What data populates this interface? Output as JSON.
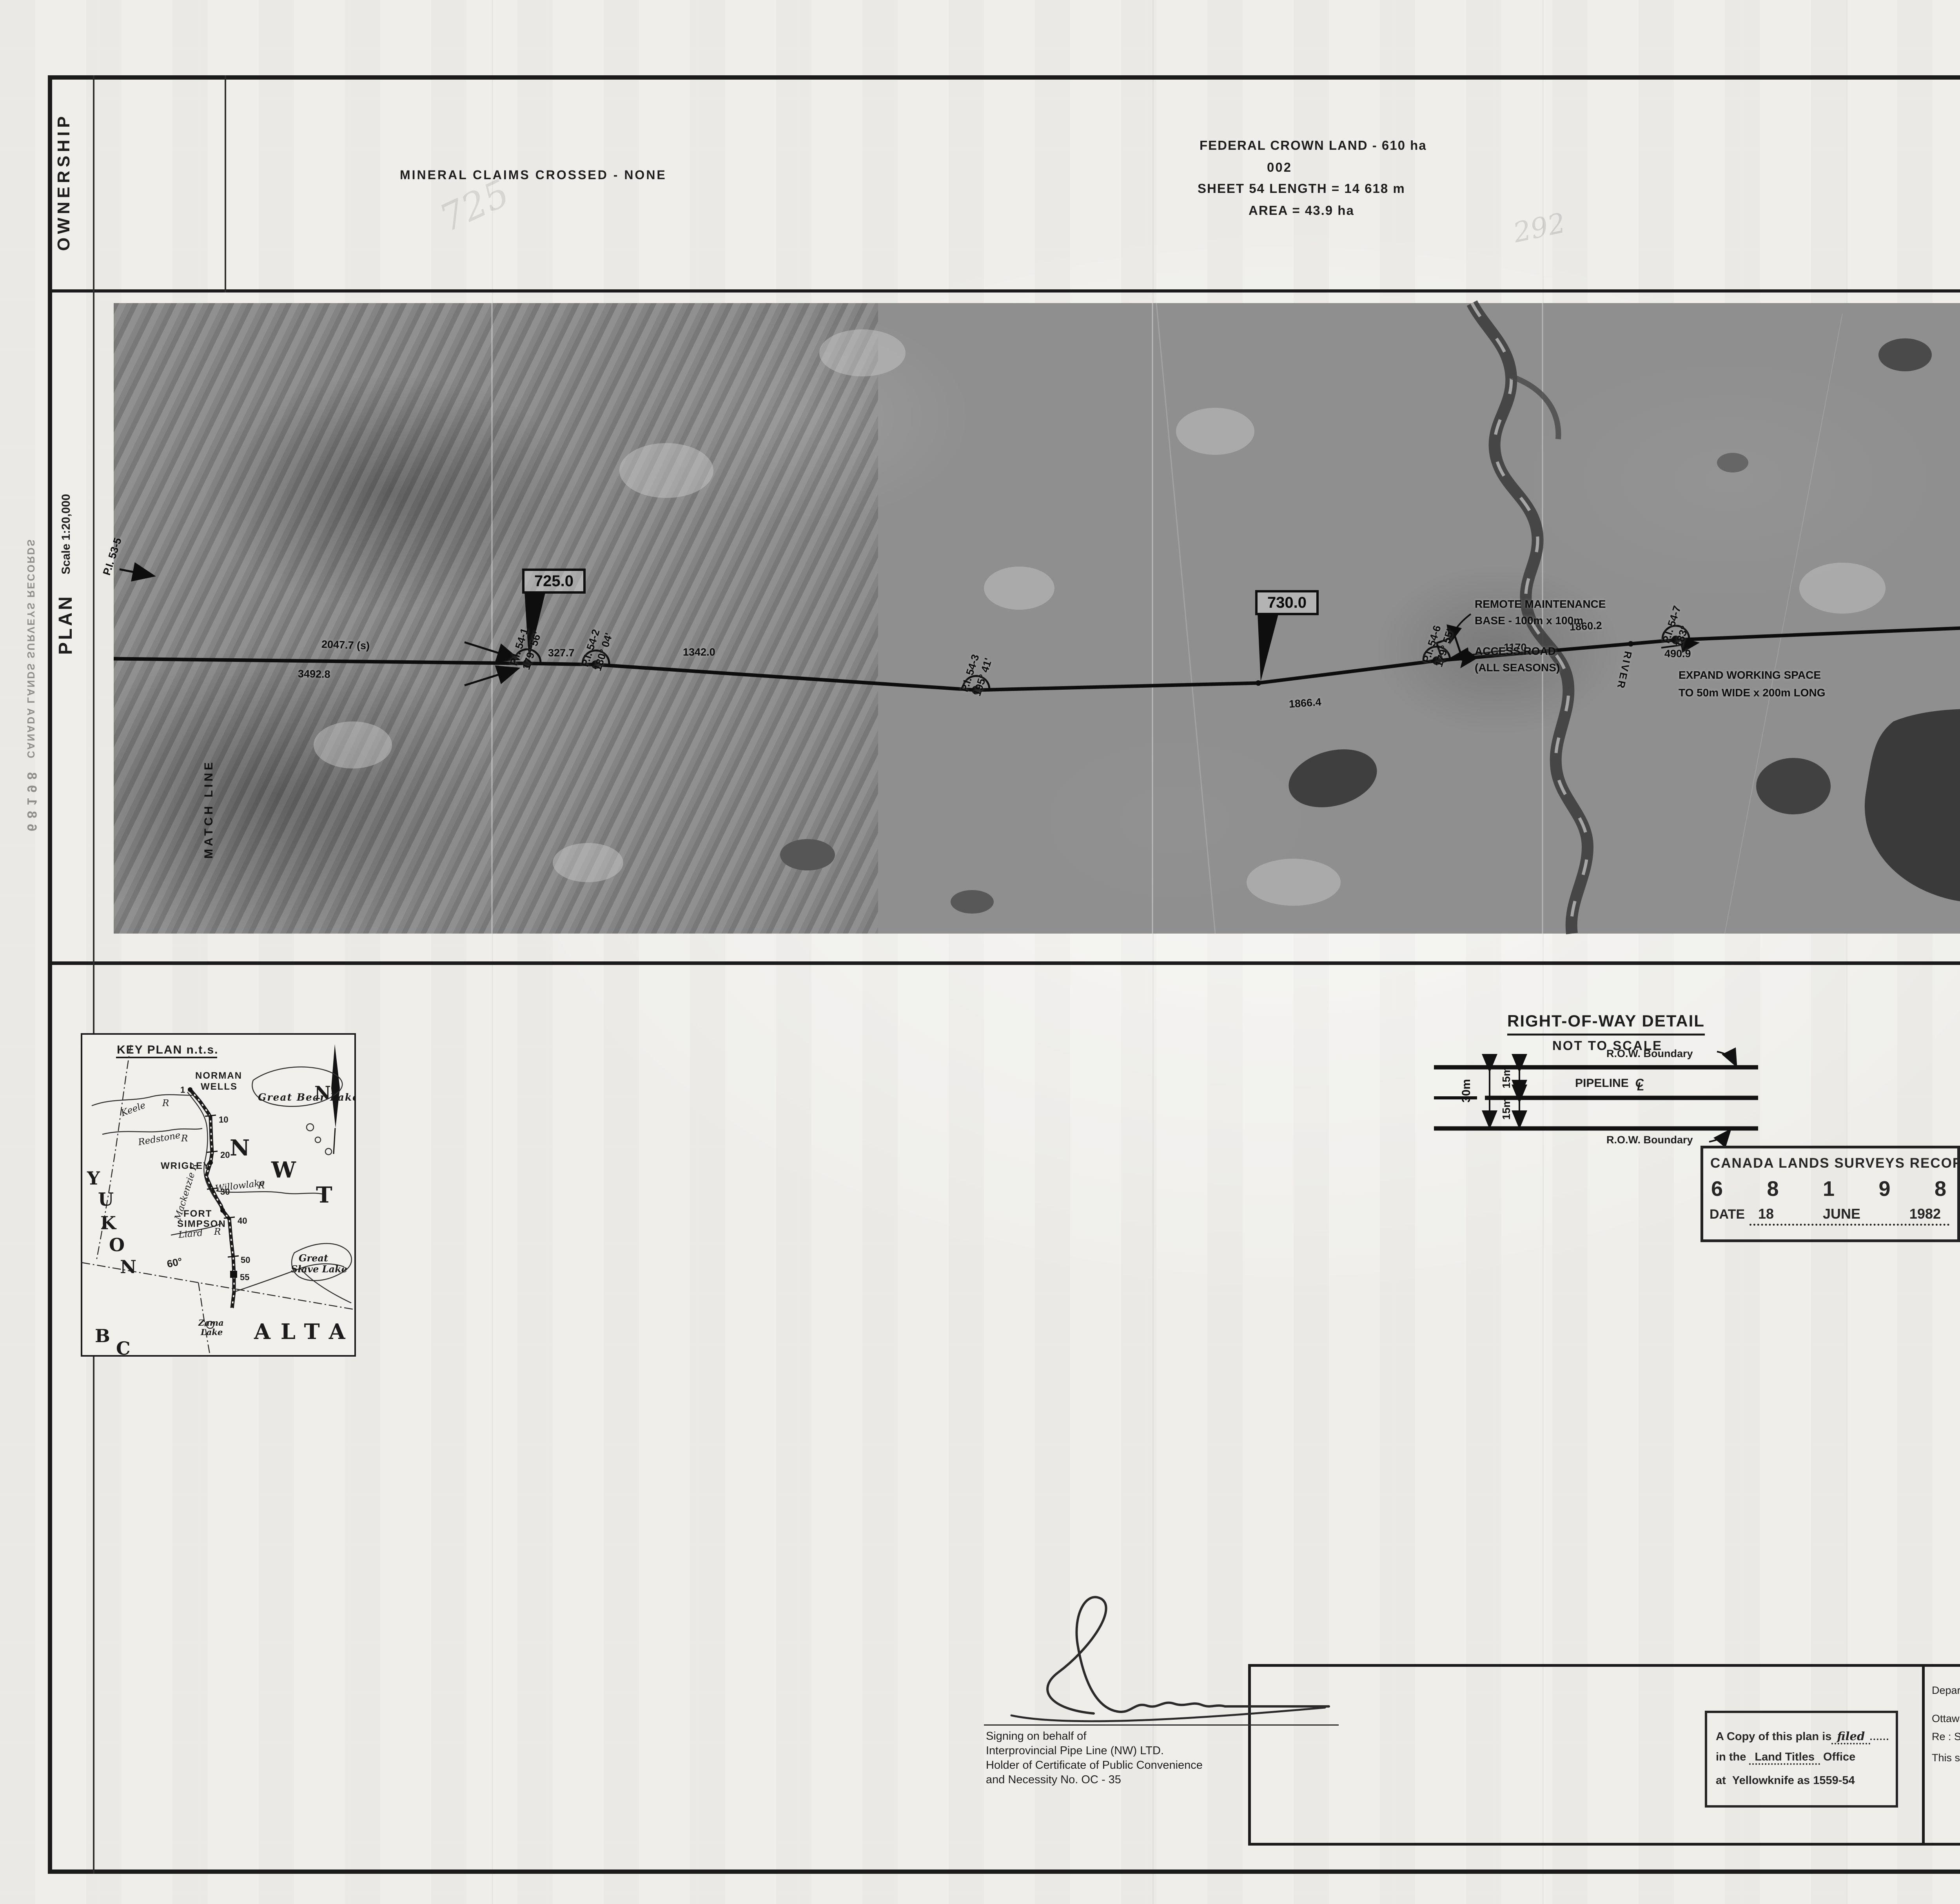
{
  "ownership": {
    "label": "OWNERSHIP",
    "mineral": "MINERAL CLAIMS CROSSED - NONE",
    "crown": "FEDERAL CROWN LAND - 610 ha",
    "parcel": "002",
    "length": "SHEET 54 LENGTH = 14 618 m",
    "area": "AREA   = 43.9 ha"
  },
  "sheetbox": {
    "word": "SHEET",
    "number": "54",
    "of": "of",
    "total": "55"
  },
  "planband": {
    "label": "PLAN",
    "scale": "Scale  1:20,000",
    "match": "MATCH LINE",
    "pencil1": "725",
    "pencil2": "292"
  },
  "photo": {
    "flag1": "725.0",
    "flag2": "730.0",
    "flag3": "735.0",
    "pi535": "P.I. 53-5",
    "pi541": "P.I. 54-1",
    "pi541a": "179° 56'",
    "pi542": "P.I. 54-2",
    "pi542a": "180° 04'",
    "pi543": "P.I. 54-3",
    "pi543a": "195° 41'",
    "pi546": "P.I. 54-6",
    "pi546a": "179° 55'",
    "pi547": "P.I. 54-7",
    "pi547a": "183°",
    "pi548": "P.I. 54-8",
    "pi548a": "189° 46'",
    "d1": "3492.8",
    "d2": "2047.7 (s)",
    "d3": "327.7",
    "d4": "1342.0",
    "d5": "1866.4",
    "d6": "1170",
    "d7": "1860.2",
    "d8": "490.9",
    "d9": "3783.7",
    "d10": "788.4",
    "d11": "5310.7",
    "remote1": "REMOTE MAINTENANCE",
    "remote2": "BASE - 100m x 100m",
    "access1": "ACCESS ROAD",
    "access2": "(ALL SEASONS)",
    "expand1": "EXPAND WORKING SPACE",
    "expand2": "TO 50m WIDE x 200m LONG",
    "river": "RIVER",
    "north": "N"
  },
  "keymap": {
    "title": "KEY PLAN n.t.s.",
    "norman1": "NORMAN",
    "norman2": "WELLS",
    "gbl": "Great Bear Lake",
    "keele": "Keele",
    "keele_r": "R",
    "redstone": "Redstone",
    "redstone_r": "R",
    "wrigley": "WRIGLEY",
    "mackenzie": "Mackenzie R",
    "willow": "Willowlake",
    "willow_r": "R",
    "fort": "FORT",
    "simpson": "SIMPSON",
    "liard": "Liard",
    "liard_r": "R",
    "sixty": "60°",
    "y": "Y",
    "u": "U",
    "k": "K",
    "o": "O",
    "n": "N",
    "nwt_n": "N",
    "nwt_w": "W",
    "nwt_t": "T",
    "b": "B",
    "c": "C",
    "alta": "ALTA",
    "gsl1": "Great",
    "gsl2": "Slave Lake",
    "zama1": "Zama",
    "zama2": "Lake",
    "north": "N",
    "t1": "1",
    "t10": "10",
    "t20": "20",
    "t30": "30",
    "t40": "40",
    "t50": "50",
    "t55": "55"
  },
  "rowdetail": {
    "title": "RIGHT-OF-WAY DETAIL",
    "nts": "NOT TO SCALE",
    "rowb_top": "R.O.W. Boundary",
    "rowb_bot": "R.O.W. Boundary",
    "pipeline": "PIPELINE",
    "cl_c": "C",
    "cl_l": "L",
    "dim30": "30m",
    "dim15a": "15m",
    "dim15b": "15m"
  },
  "clsr": {
    "title": "CANADA LANDS SURVEYS RECORDS",
    "d1": "6",
    "d2": "8",
    "d3": "1",
    "d4": "9",
    "d5": "8",
    "datelabel": "DATE",
    "day": "18",
    "month": "JUNE",
    "year": "1982"
  },
  "titleblock": {
    "l1": "PLAN AND FIELD NOTES OF CENTRE LINE OF",
    "l2": "30 METRE PIPELINE RIGHT-OF-WAY",
    "l3": "FOR INTERPROVINCIAL PIPE LINE (NW) LTD. THROUGH",
    "l4": "PART OF THE NORTHWEST TERRITORIES",
    "scale_label": "SCALE",
    "scale_value": "1 : 20 000",
    "b0": "500",
    "b1": "0",
    "b2": "500",
    "b3": "1000",
    "b4": "1500",
    "b5": "2000",
    "exec1": "THIS SURVEY WAS EXECUTED DURING THE PERIOD MARCH 10, 1981 TO JUNE 30, 1982",
    "exec2": "BY WILLIAM D. BUCK    C.L.S."
  },
  "legend": {
    "heading": "LEGEND :",
    "i1": "C.L.S. posts found shown thus",
    "i2": "Square Iron bars 13 mm by 45 cm or 30 cm spikes shown thus",
    "i3": "Centre line of pipeline is shown thus",
    "i4": "Lands dealt with by this plan bounded thus ( see detail )",
    "i5": "Distances are in metres and decimals thereof .",
    "i6": "Pipeline right-of-way is 30 m wide unless shown otherwise ."
  },
  "affidavit": {
    "l1a": "I ,",
    "name": "William D. Buck",
    "l1b": "of the City of Edmonton , Canada Lands Surveyor ,",
    "l2": "make oath and say that I have in my own proper person , according to law",
    "l3": "and the instructions of the Surveyor General of Canada Lands , faithfully",
    "l4": "and correctly executed the survey shown by this plan and field notes ,",
    "l5": "and that the said plan and field notes are correct and true to the best",
    "l6": "of my knowledge and belief",
    "l7": "SO HELP ME GOD .",
    "sworn1": "Sworn before me at the",
    "sworn2": "City of Edmonton",
    "this": "this",
    "day": "20",
    "dayof": "day of",
    "month": "July",
    "year": ", 1982",
    "cls1": "Canada Lands Surveyor",
    "cls2": "Canada Lands Surveyor"
  },
  "copystamp": {
    "l1a": "A Copy of this plan is",
    "l1b": "filed",
    "l2a": "in the",
    "l2b": "Land Titles",
    "l2c": "Office",
    "l3a": "at",
    "l3b": "Yellowknife as 1559-54"
  },
  "dia": {
    "l1": "Department of Indian Affairs and Northern Development",
    "ottawa": "Ottawa",
    "date": "September 9",
    "year": ", 1982",
    "re": "Re : Section 43 Canada Lands Surveys Act",
    "sat": "This survey and plan are satisfactory",
    "forword": "for",
    "minister": "Minister"
  },
  "emr": {
    "l1": "Department of Energy Mines and Resources",
    "ottawa": "Ottawa",
    "date": "24 September",
    "year": ", 1982",
    "re": "Re : Section 43 Canada Lands Surveys Act",
    "c1": "Confirmed insofar as Crown Canada Lands",
    "c2": "are affected .",
    "caption": "Surveyor General",
    "item": "Item : 1-82PL",
    "exmd": "Ex'md : 9xP 9/9/82",
    "ok": "OK"
  },
  "ipl": {
    "l1": "Signing on behalf of",
    "l2": "Interprovincial Pipe Line (NW) LTD.",
    "l3": "Holder of Certificate of Public Convenience",
    "l4": "and Necessity No. OC - 35"
  },
  "edge": {
    "num": "68198",
    "text": "CANADA LANDS SURVEYS RECORDS"
  }
}
